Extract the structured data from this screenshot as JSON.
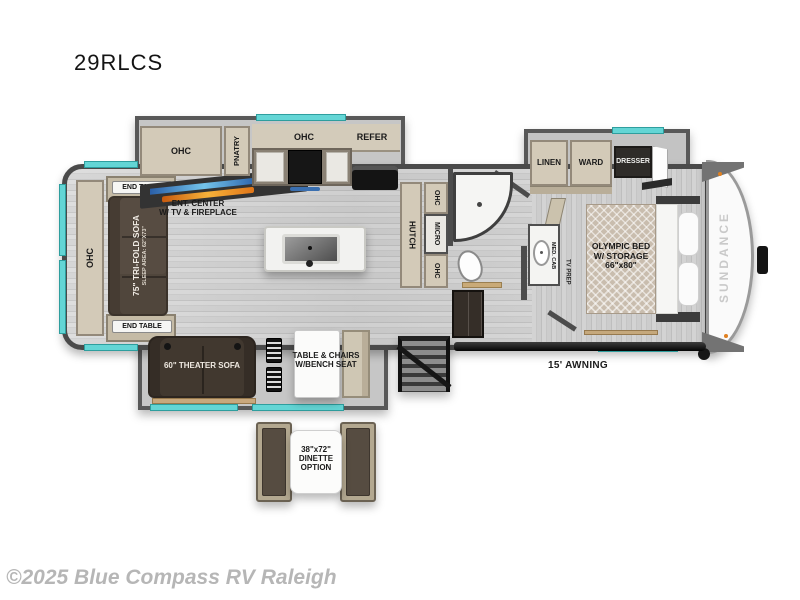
{
  "title": "29RLCS",
  "watermark": "©2025 Blue Compass RV Raleigh",
  "floorplan": {
    "brand": "SUNDANCE",
    "awning": "15' AWNING",
    "rear": {
      "ohc": "OHC",
      "end_table_top": "END TABLE",
      "end_table_bottom": "END TABLE",
      "sofa": "75\" TRI-FOLD SOFA",
      "sofa_sleep_area": "SLEEP AREA: 62\"X73\""
    },
    "kitchen": {
      "ohc_left": "OHC",
      "pantry": "PNATRY",
      "ohc_right": "OHC",
      "refer": "REFER",
      "ent_line1": "ENT. CENTER",
      "ent_line2": "W/ TV & FIREPLACE",
      "hutch": "HUTCH",
      "ohc_top": "OHC",
      "micro": "MICRO",
      "ohc_bottom": "OHC"
    },
    "bedroom": {
      "linen": "LINEN",
      "ward": "WARD",
      "dresser": "DRESSER",
      "med_cab": "MED. CAB",
      "tv_prep": "TV PREP",
      "bed_line1": "OLYMPIC BED",
      "bed_line2": "W/ STORAGE",
      "bed_line3": "66\"x80\""
    },
    "living": {
      "theater_sofa": "60\" THEATER SOFA",
      "table_line1": "TABLE & CHAIRS",
      "table_line2": "W/BENCH SEAT"
    },
    "dinette_option": {
      "line1": "38\"x72\"",
      "line2": "DINETTE",
      "line3": "OPTION"
    },
    "colors": {
      "accent_teal": "#63d5d5",
      "wall_gray": "#4c4c4c",
      "cabinet_tan": "#d3cab8",
      "sofa_brown": "#50463c",
      "floor_gray": "#d2d2d2"
    }
  }
}
